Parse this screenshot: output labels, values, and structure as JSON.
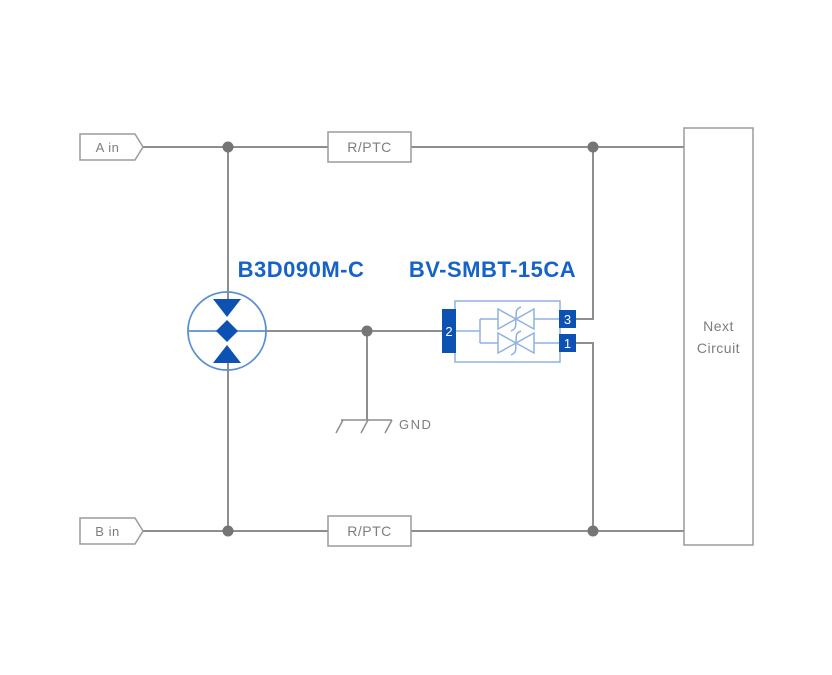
{
  "diagram": {
    "inputs": {
      "a": "A in",
      "b": "B in"
    },
    "resistors": {
      "top": "R/PTC",
      "bottom": "R/PTC"
    },
    "gdt": {
      "label": "B3D090M-C"
    },
    "tvs": {
      "label": "BV-SMBT-15CA",
      "pins": {
        "left": "2",
        "top_right": "3",
        "bottom_right": "1"
      }
    },
    "ground": {
      "label": "GND"
    },
    "next_circuit": {
      "line1": "Next",
      "line2": "Circuit"
    },
    "colors": {
      "wire": "#8e8e8e",
      "dot": "#757575",
      "box_border": "#9b9b9b",
      "blue_dark": "#0d52b2",
      "blue_stroke": "#5b8fd3",
      "blue_stroke_light": "#8fb2e4",
      "blue_text": "#1663c7",
      "gray_text": "#7d7d7d"
    }
  }
}
